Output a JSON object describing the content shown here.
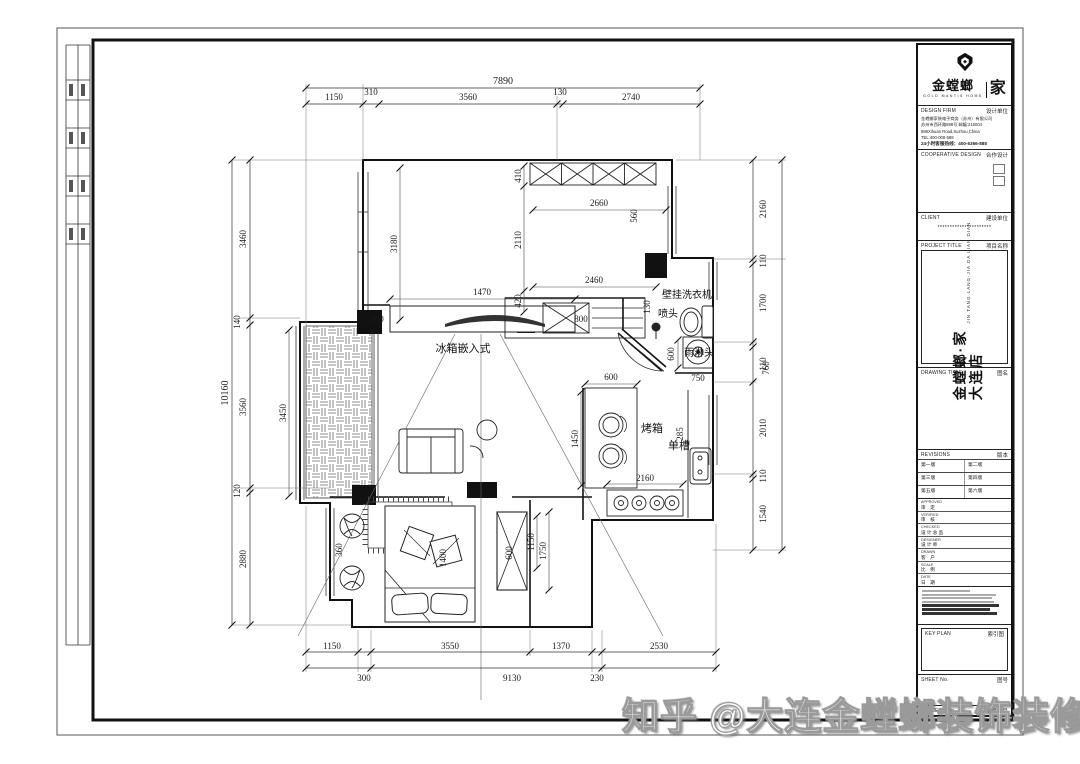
{
  "sheet": {
    "watermark": "知乎 @大连金螳螂装饰装修"
  },
  "titleblock": {
    "logo": {
      "cn": "金螳螂",
      "home": "家",
      "sub": "GOLD MANTIS HOME"
    },
    "design_firm": {
      "en": "DESIGN FIRM",
      "cn": "设计单位",
      "company": "金螳螂家装电子商务（苏州）有限公司",
      "address_cn": "苏州市西环路888号 邮编:215004",
      "address_en": "888Xihuan Road,Suzhou,China",
      "tel": "TEL:400-008-588",
      "hotline": "24小时客服热线：400-6366-888"
    },
    "cooperative": {
      "en": "COOPERATIVE DESIGN",
      "cn": "合作设计"
    },
    "client": {
      "en": "CLIENT",
      "cn": "建设单位",
      "value": "**********************"
    },
    "project": {
      "en": "PROJECT TITLE",
      "cn": "项目名称",
      "name_line1": "金螳螂·家",
      "name_line2": "大连店",
      "name_en": "JIN TANG LANG·JIA  DA LIAN DIAN"
    },
    "drawing": {
      "en": "DRAWING TITLE",
      "cn": "图名"
    },
    "revisions": {
      "en": "REVISIONS",
      "cn": "版本",
      "rows": [
        [
          "第一版",
          "第二版"
        ],
        [
          "第三版",
          "第四版"
        ],
        [
          "第五版",
          "第六版"
        ]
      ]
    },
    "signoff": [
      {
        "en": "APPROVED",
        "cn": "审　定"
      },
      {
        "en": "VERIFIED",
        "cn": "审　核"
      },
      {
        "en": "CHECKED",
        "cn": "设 计 总 监"
      },
      {
        "en": "DESIGNER",
        "cn": "设 计 师"
      },
      {
        "en": "DRAWN",
        "cn": "客　户"
      },
      {
        "en": "SCALE",
        "cn": "比　例"
      },
      {
        "en": "DATE",
        "cn": "日　期"
      }
    ],
    "keyplan": {
      "en": "KEY PLAN",
      "cn": "索引图"
    },
    "sheet_no": {
      "en": "SHEET No.",
      "cn": "图号"
    },
    "project_no": {
      "en": "PROJECT No.",
      "cn": "项目编号"
    }
  },
  "plan": {
    "labels": {
      "fridge": "冰箱嵌入式",
      "washer": "壁挂洗衣机",
      "sprayer": "喷头",
      "rain_shower": "雨淋头",
      "oven": "烤箱",
      "sink": "单槽"
    },
    "dims": {
      "top_total": "7890",
      "top_segs": [
        "1150",
        "310",
        "3560",
        "130",
        "2740"
      ],
      "left_total": "10160",
      "left_segs": [
        "3460",
        "140",
        "3560",
        "120",
        "2880"
      ],
      "right_segs": [
        "2160",
        "110",
        "1700",
        "110",
        "760",
        "2010",
        "110",
        "1540"
      ],
      "bottom_row1": [
        "1150",
        "3550",
        "1370",
        "2530"
      ],
      "bottom_row2": [
        "300",
        "9130",
        "230"
      ],
      "interior": {
        "tv_width": "1470",
        "tv_left": "900",
        "tv_right": "800",
        "room_height": "3180",
        "right_chain_top": "410",
        "right_chain_mid": "2110",
        "right_chain_bot": "420",
        "top_room_width": "2660",
        "top_room_side": "560",
        "counter_width": "2460",
        "balcony_height": "3450",
        "island_width": "600",
        "island_height": "1450",
        "stove_width": "2160",
        "sink_side": "285",
        "washer_side": "600",
        "washer_width": "750",
        "bath_side": "130",
        "wardrobe_depth": "600",
        "wardrobe_height": "1750",
        "hall_width": "1150",
        "plant_side": "360",
        "bed_width": "1400"
      }
    }
  }
}
